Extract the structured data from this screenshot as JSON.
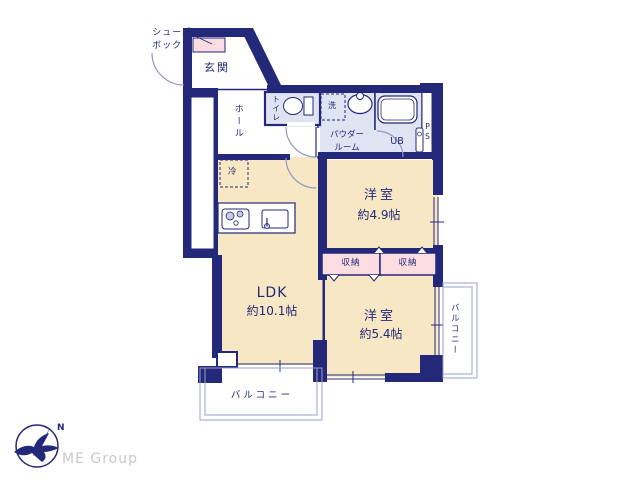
{
  "floorplan": {
    "entrance": {
      "label": "玄関"
    },
    "shoe_box": {
      "line1": "シューズ",
      "line2": "ボックス"
    },
    "hall": {
      "label": "ホール"
    },
    "toilet": {
      "label": "トイレ"
    },
    "laundry": {
      "label": "洗"
    },
    "powder_room": {
      "line1": "パウダー",
      "line2": "ルーム"
    },
    "unit_bath": {
      "label": "UB"
    },
    "pipe_space": {
      "label": "PS"
    },
    "refrigerator": {
      "label": "冷"
    },
    "bedroom1": {
      "name": "洋室",
      "size": "約4.9帖"
    },
    "bedroom2": {
      "name": "洋室",
      "size": "約5.4帖"
    },
    "ldk": {
      "name": "LDK",
      "size": "約10.1帖"
    },
    "storage_left": {
      "label": "収納"
    },
    "storage_right": {
      "label": "収納"
    },
    "balcony_bottom": {
      "label": "バルコニー"
    },
    "balcony_right": {
      "label": "バルコニー"
    }
  },
  "branding": {
    "logo_text": "ME Group",
    "compass_letter": "N"
  },
  "colors": {
    "wall_navy": "#232878",
    "room_cream": "#f7e7c4",
    "closet_pink": "#fadce1",
    "bath_blue": "#dfe4f3",
    "light_line": "#9aa0cc",
    "logo_gray": "#c9c9c9"
  }
}
